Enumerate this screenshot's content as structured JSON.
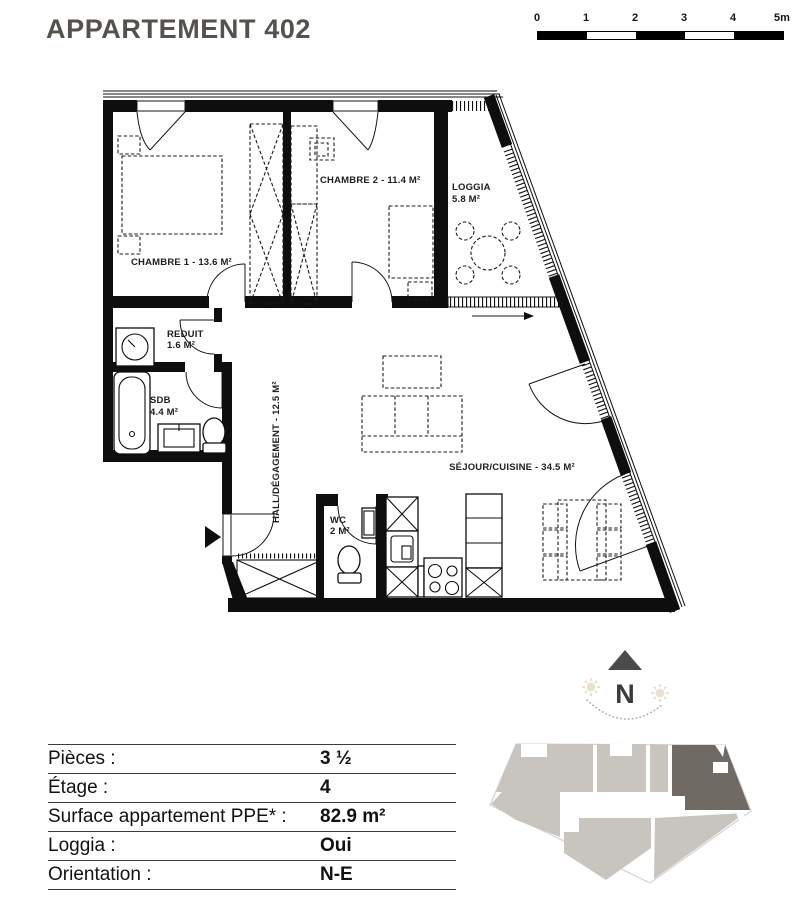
{
  "title": "APPARTEMENT 402",
  "scale_bar": {
    "labels": [
      "0",
      "1",
      "2",
      "3",
      "4",
      "5m"
    ]
  },
  "compass": {
    "letter": "N"
  },
  "plan": {
    "rooms": {
      "chambre1": {
        "label": "CHAMBRE 1 - 13.6 M²"
      },
      "chambre2": {
        "label": "CHAMBRE 2 - 11.4 M²"
      },
      "loggia": {
        "name": "LOGGIA",
        "area": "5.8 M²"
      },
      "reduit": {
        "name": "REDUIT",
        "area": "1.6 M²"
      },
      "sdb": {
        "name": "SDB",
        "area": "4.4 M²"
      },
      "hall": {
        "label": "HALL/DÉGAGEMENT - 12.5 M²"
      },
      "wc": {
        "name": "WC",
        "area": "2 M²"
      },
      "sejour": {
        "label": "SÉJOUR/CUISINE - 34.5 M²"
      }
    }
  },
  "info_table": {
    "rows": [
      {
        "label": "Pièces :",
        "value": "3 ½"
      },
      {
        "label": "Étage :",
        "value": "4"
      },
      {
        "label": "Surface appartement PPE* :",
        "value": "82.9 m²"
      },
      {
        "label": "Loggia :",
        "value": "Oui"
      },
      {
        "label": "Orientation :",
        "value": "N-E"
      }
    ]
  },
  "colors": {
    "plan_ink": "#0e0e0e",
    "title_ink": "#55524e",
    "building_light": "#c8c4c0",
    "building_dark": "#6f6a64",
    "compass_sun": "#e9e2d0"
  }
}
